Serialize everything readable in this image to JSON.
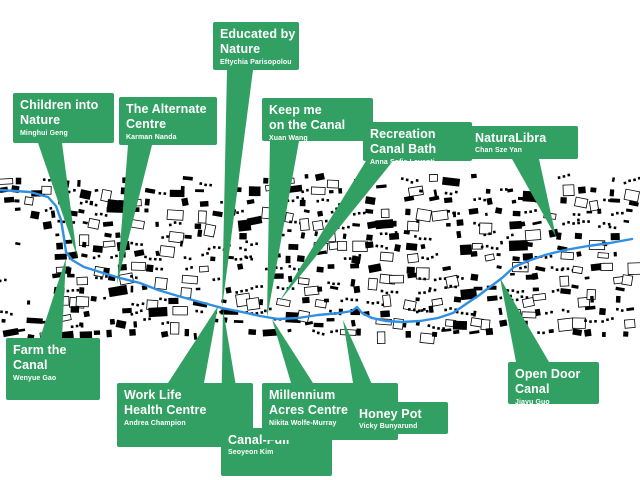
{
  "map": {
    "name": "canal-masterplan-map",
    "background_color": "#ffffff",
    "building_color": "#000000",
    "canal_color": "#2f8fe3",
    "label_color": "#31a062",
    "label_text_color": "#ffffff",
    "band": {
      "top": 177,
      "bottom": 342
    },
    "canal_path": [
      [
        0,
        190
      ],
      [
        30,
        192
      ],
      [
        48,
        197
      ],
      [
        56,
        206
      ],
      [
        61,
        220
      ],
      [
        64,
        238
      ],
      [
        66,
        252
      ],
      [
        72,
        260
      ],
      [
        84,
        267
      ],
      [
        100,
        272
      ],
      [
        120,
        278
      ],
      [
        140,
        283
      ],
      [
        158,
        290
      ],
      [
        178,
        296
      ],
      [
        200,
        302
      ],
      [
        222,
        308
      ],
      [
        242,
        312
      ],
      [
        260,
        316
      ],
      [
        278,
        319
      ],
      [
        298,
        318
      ],
      [
        318,
        315
      ],
      [
        340,
        313
      ],
      [
        352,
        311
      ],
      [
        357,
        307
      ],
      [
        362,
        313
      ],
      [
        372,
        318
      ],
      [
        386,
        321
      ],
      [
        402,
        322
      ],
      [
        420,
        321
      ],
      [
        438,
        318
      ],
      [
        453,
        313
      ],
      [
        466,
        304
      ],
      [
        478,
        296
      ],
      [
        490,
        287
      ],
      [
        502,
        278
      ],
      [
        514,
        267
      ],
      [
        528,
        261
      ],
      [
        545,
        255
      ],
      [
        565,
        250
      ],
      [
        588,
        246
      ],
      [
        610,
        243
      ],
      [
        632,
        239
      ]
    ]
  },
  "labels": [
    {
      "id": "educated-by-nature",
      "title": "Educated by\nNature",
      "author": "Eftychia Parisopolou",
      "box": {
        "x": 213,
        "y": 22,
        "w": 86,
        "h": 48
      },
      "tail": {
        "edge": "bottom",
        "x1": 227,
        "x2": 253,
        "ax": 222,
        "ay": 308
      }
    },
    {
      "id": "children-into-nature",
      "title": "Children into\nNature",
      "author": "Minghui Geng",
      "box": {
        "x": 13,
        "y": 93,
        "w": 101,
        "h": 50
      },
      "tail": {
        "edge": "bottom",
        "x1": 38,
        "x2": 62,
        "ax": 77,
        "ay": 256
      }
    },
    {
      "id": "the-alternate-centre",
      "title": "The Alternate\nCentre",
      "author": "Karman Nanda",
      "box": {
        "x": 119,
        "y": 97,
        "w": 98,
        "h": 48
      },
      "tail": {
        "edge": "bottom",
        "x1": 128,
        "x2": 152,
        "ax": 117,
        "ay": 284
      }
    },
    {
      "id": "keep-me-on-the-canal",
      "title": "Keep me\non the Canal",
      "author": "Xuan Wang",
      "box": {
        "x": 262,
        "y": 98,
        "w": 111,
        "h": 43
      },
      "tail": {
        "edge": "bottom",
        "x1": 270,
        "x2": 299,
        "ax": 267,
        "ay": 318
      }
    },
    {
      "id": "recreation-canal-bath",
      "title": "Recreation\nCanal Bath",
      "author": "Anna Sofia Lavanti",
      "box": {
        "x": 363,
        "y": 122,
        "w": 109,
        "h": 39
      },
      "tail": {
        "edge": "bottom",
        "x1": 366,
        "x2": 393,
        "ax": 279,
        "ay": 302
      }
    },
    {
      "id": "naturalibra",
      "title": "NaturaLibra",
      "author": "Chan Sze Yan",
      "box": {
        "x": 468,
        "y": 126,
        "w": 110,
        "h": 33
      },
      "tail": {
        "edge": "bottom",
        "x1": 512,
        "x2": 539,
        "ax": 556,
        "ay": 237
      }
    },
    {
      "id": "farm-the-canal",
      "title": "Farm the\nCanal",
      "author": "Wenyue Gao",
      "box": {
        "x": 6,
        "y": 338,
        "w": 94,
        "h": 62
      },
      "tail": {
        "edge": "top",
        "x1": 40,
        "x2": 62,
        "ax": 66,
        "ay": 258
      }
    },
    {
      "id": "work-life-health-centre",
      "title": "Work Life\nHealth Centre",
      "author": "Andrea Champion",
      "box": {
        "x": 117,
        "y": 383,
        "w": 136,
        "h": 64
      },
      "tail": {
        "edge": "top",
        "x1": 168,
        "x2": 204,
        "ax": 218,
        "ay": 306
      }
    },
    {
      "id": "canal-full",
      "title": "Canal-Full",
      "author": "Seoyeon Kim",
      "box": {
        "x": 221,
        "y": 428,
        "w": 111,
        "h": 48
      },
      "tail": {
        "edge": "top",
        "x1": 221,
        "x2": 243,
        "ax": 223,
        "ay": 309
      }
    },
    {
      "id": "millennium-acres-centre",
      "title": "Millennium\nAcres Centre",
      "author": "Nikita Wolfe-Murray",
      "box": {
        "x": 262,
        "y": 383,
        "w": 136,
        "h": 57
      },
      "tail": {
        "edge": "top",
        "x1": 291,
        "x2": 313,
        "ax": 272,
        "ay": 319
      }
    },
    {
      "id": "honey-pot",
      "title": "Honey Pot",
      "author": "Vicky Bunyarund",
      "box": {
        "x": 352,
        "y": 402,
        "w": 96,
        "h": 32
      },
      "tail": {
        "edge": "top",
        "x1": 356,
        "x2": 380,
        "ax": 343,
        "ay": 320
      }
    },
    {
      "id": "open-door-canal",
      "title": "Open Door\nCanal",
      "author": "Jiayu Guo",
      "box": {
        "x": 508,
        "y": 362,
        "w": 91,
        "h": 42
      },
      "tail": {
        "edge": "top",
        "x1": 516,
        "x2": 549,
        "ax": 500,
        "ay": 278
      }
    }
  ]
}
